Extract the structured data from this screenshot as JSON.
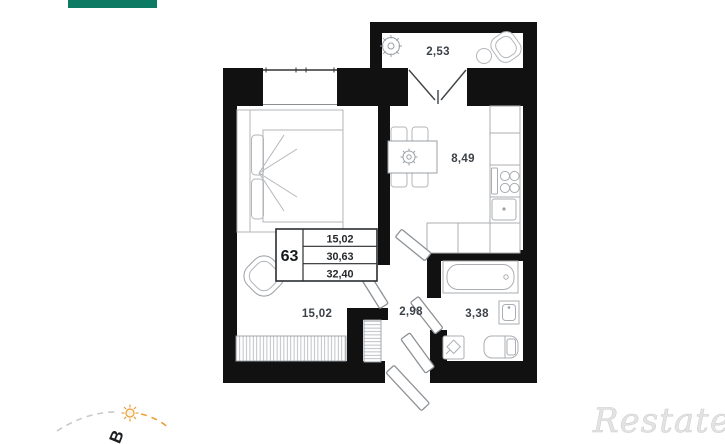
{
  "window": {
    "background": "#ffffff"
  },
  "toolbar": {
    "accent_bar_color": "#0d7a63"
  },
  "floorplan": {
    "wall_color": "#111111",
    "furniture_color": "#b3b6ba",
    "door_color": "#8d9297",
    "label_color": "#3c4247",
    "rooms": [
      {
        "name": "balcony",
        "area": "2,53"
      },
      {
        "name": "kitchen",
        "area": "8,49"
      },
      {
        "name": "living-room",
        "area": "15,02"
      },
      {
        "name": "hall",
        "area": "2,98"
      },
      {
        "name": "bathroom",
        "area": "3,38"
      }
    ],
    "stamp": {
      "apartment_number": "63",
      "areas": [
        "15,02",
        "30,63",
        "32,40"
      ]
    }
  },
  "compass": {
    "direction_label": "В",
    "sun_color": "#e7a03c",
    "arc_color_gray": "#c9c9c9",
    "arc_color_orange": "#e7a03c"
  },
  "watermark": {
    "text": "Restate",
    "color": "#e3e3e3"
  }
}
